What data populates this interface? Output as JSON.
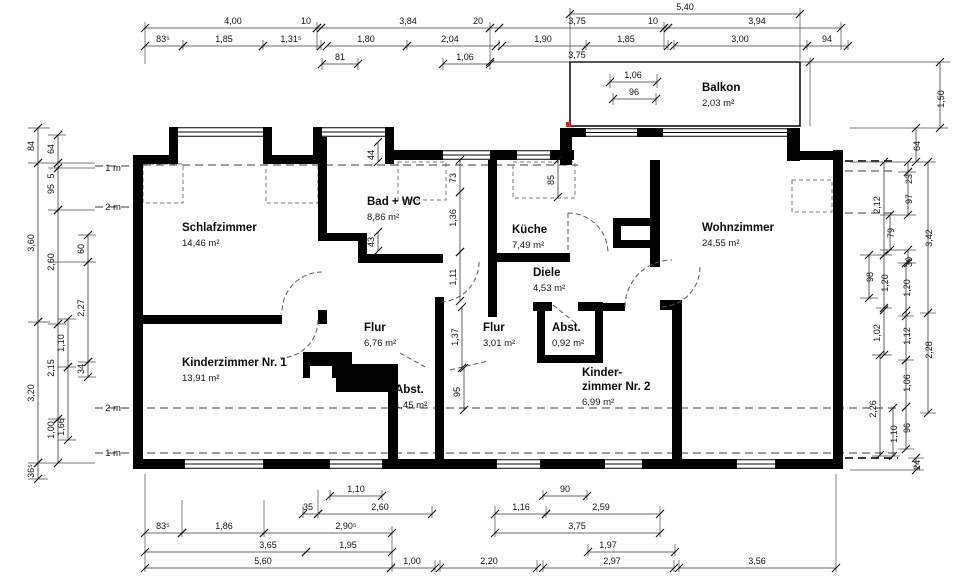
{
  "plan": {
    "rooms": [
      {
        "name": "Schlafzimmer",
        "area": "14,46 m²",
        "x": 182,
        "y": 231
      },
      {
        "name": "Bad + WC",
        "area": "8,86 m²",
        "x": 367,
        "y": 205
      },
      {
        "name": "Küche",
        "area": "7,49 m²",
        "x": 512,
        "y": 233
      },
      {
        "name": "Diele",
        "area": "4,53 m²",
        "x": 533,
        "y": 276
      },
      {
        "name": "Wohnzimmer",
        "area": "24,55 m²",
        "x": 702,
        "y": 231
      },
      {
        "name": "Balkon",
        "area": "2,03 m²",
        "x": 702,
        "y": 91
      },
      {
        "name": "Flur",
        "area": "6,76 m²",
        "x": 364,
        "y": 331
      },
      {
        "name": "Flur",
        "area": "3,01 m²",
        "x": 483,
        "y": 331
      },
      {
        "name": "Abst.",
        "area": "0,92 m²",
        "x": 552,
        "y": 331
      },
      {
        "name": "Kinderzimmer Nr. 1",
        "area": "13,91 m²",
        "x": 182,
        "y": 366
      },
      {
        "name": "Abst.",
        "area": "1,45 m²",
        "x": 395,
        "y": 393
      },
      {
        "name": "Kinder-|zimmer Nr. 2",
        "area": "6,99 m²",
        "x": 582,
        "y": 376
      }
    ],
    "height_labels": [
      {
        "t": "1 m",
        "x": 113,
        "y": 171
      },
      {
        "t": "2 m",
        "x": 113,
        "y": 210
      },
      {
        "t": "2 m",
        "x": 113,
        "y": 411
      },
      {
        "t": "1 m",
        "x": 113,
        "y": 456
      }
    ],
    "dimensions": [
      {
        "t": "5,40",
        "o": "h",
        "l": [
          570,
          14,
          800,
          14
        ],
        "x": 685,
        "y": 10
      },
      {
        "t": "4,00",
        "o": "h",
        "l": [
          145,
          28,
          317,
          28
        ],
        "x": 233,
        "y": 24
      },
      {
        "t": "10",
        "o": "h",
        "l": [
          317,
          28,
          321,
          28
        ],
        "x": 306,
        "y": 24
      },
      {
        "t": "3,84",
        "o": "h",
        "l": [
          321,
          28,
          490,
          28
        ],
        "x": 408,
        "y": 24
      },
      {
        "t": "20",
        "o": "h",
        "l": [
          490,
          28,
          499,
          28
        ],
        "x": 478,
        "y": 24
      },
      {
        "t": "3,75",
        "o": "h",
        "l": [
          499,
          28,
          664,
          28
        ],
        "x": 577,
        "y": 24
      },
      {
        "t": "10",
        "o": "h",
        "l": [
          664,
          28,
          668,
          28
        ],
        "x": 653,
        "y": 24
      },
      {
        "t": "3,94",
        "o": "h",
        "l": [
          668,
          28,
          841,
          28
        ],
        "x": 757,
        "y": 24
      },
      {
        "t": "83⁵",
        "o": "h",
        "l": [
          145,
          46,
          183,
          46
        ],
        "x": 163,
        "y": 42
      },
      {
        "t": "1,85",
        "o": "h",
        "l": [
          183,
          46,
          263,
          46
        ],
        "x": 224,
        "y": 42
      },
      {
        "t": "1,31⁵",
        "o": "h",
        "l": [
          263,
          46,
          321,
          46
        ],
        "x": 291,
        "y": 42
      },
      {
        "t": "1,80",
        "o": "h",
        "l": [
          327,
          46,
          407,
          46
        ],
        "x": 366,
        "y": 42
      },
      {
        "t": "2,04",
        "o": "h",
        "l": [
          407,
          46,
          496,
          46
        ],
        "x": 450,
        "y": 42
      },
      {
        "t": "1,90",
        "o": "h",
        "l": [
          502,
          46,
          586,
          46
        ],
        "x": 543,
        "y": 42
      },
      {
        "t": "1,85",
        "o": "h",
        "l": [
          586,
          46,
          668,
          46
        ],
        "x": 626,
        "y": 42
      },
      {
        "t": "3,00",
        "o": "h",
        "l": [
          674,
          46,
          807,
          46
        ],
        "x": 740,
        "y": 42
      },
      {
        "t": "94",
        "o": "h",
        "l": [
          807,
          46,
          848,
          46
        ],
        "x": 827,
        "y": 42
      },
      {
        "t": "81",
        "o": "h",
        "l": [
          322,
          64,
          358,
          64
        ],
        "x": 340,
        "y": 60
      },
      {
        "t": "1,06",
        "o": "h",
        "l": [
          443,
          64,
          490,
          64
        ],
        "x": 465,
        "y": 60
      },
      {
        "t": "3,75",
        "o": "h",
        "l": [
          490,
          62,
          810,
          62
        ],
        "x": 577,
        "y": 58
      },
      {
        "t": "1,06",
        "o": "h",
        "l": [
          610,
          82,
          657,
          82
        ],
        "x": 633,
        "y": 78
      },
      {
        "t": "96",
        "o": "h",
        "l": [
          613,
          99,
          656,
          99
        ],
        "x": 634,
        "y": 95
      },
      {
        "t": "84",
        "o": "v",
        "l": [
          38,
          128,
          38,
          163
        ],
        "x": 34,
        "y": 146
      },
      {
        "t": "3,60",
        "o": "v",
        "l": [
          38,
          163,
          38,
          322
        ],
        "x": 34,
        "y": 243
      },
      {
        "t": "3,20",
        "o": "v",
        "l": [
          38,
          322,
          38,
          463
        ],
        "x": 34,
        "y": 393
      },
      {
        "t": "36⁵",
        "o": "v",
        "l": [
          38,
          463,
          38,
          479
        ],
        "x": 34,
        "y": 471
      },
      {
        "t": "64",
        "o": "v",
        "l": [
          58,
          135,
          58,
          163
        ],
        "x": 54,
        "y": 149
      },
      {
        "t": "5",
        "o": "v",
        "l": [
          58,
          163,
          58,
          168
        ],
        "x": 54,
        "y": 176
      },
      {
        "t": "95",
        "o": "v",
        "l": [
          58,
          168,
          58,
          210
        ],
        "x": 54,
        "y": 189
      },
      {
        "t": "2,60",
        "o": "v",
        "l": [
          58,
          210,
          58,
          324
        ],
        "x": 54,
        "y": 262
      },
      {
        "t": "2,15",
        "o": "v",
        "l": [
          58,
          324,
          58,
          419
        ],
        "x": 54,
        "y": 368
      },
      {
        "t": "1,00",
        "o": "v",
        "l": [
          58,
          419,
          58,
          463
        ],
        "x": 54,
        "y": 430
      },
      {
        "t": "60",
        "o": "v",
        "l": [
          88,
          235,
          88,
          262
        ],
        "x": 84,
        "y": 249
      },
      {
        "t": "2,27",
        "o": "v",
        "l": [
          88,
          262,
          88,
          362
        ],
        "x": 84,
        "y": 308
      },
      {
        "t": "34",
        "o": "v",
        "l": [
          88,
          362,
          88,
          377
        ],
        "x": 84,
        "y": 369
      },
      {
        "t": "1,10",
        "o": "v",
        "l": [
          68,
          319,
          68,
          367
        ],
        "x": 64,
        "y": 343
      },
      {
        "t": "1,66",
        "o": "v",
        "l": [
          68,
          367,
          68,
          440
        ],
        "x": 64,
        "y": 427
      },
      {
        "t": "1,50",
        "o": "v",
        "l": [
          940,
          62,
          940,
          128
        ],
        "x": 944,
        "y": 99
      },
      {
        "t": "64",
        "o": "v",
        "l": [
          916,
          128,
          916,
          162
        ],
        "x": 920,
        "y": 146
      },
      {
        "t": "23",
        "o": "v",
        "l": [
          908,
          162,
          908,
          172
        ],
        "x": 912,
        "y": 179
      },
      {
        "t": "97",
        "o": "v",
        "l": [
          908,
          172,
          908,
          215
        ],
        "x": 912,
        "y": 199
      },
      {
        "t": "79",
        "o": "v",
        "l": [
          890,
          215,
          890,
          250
        ],
        "x": 894,
        "y": 233
      },
      {
        "t": "30",
        "o": "v",
        "l": [
          908,
          250,
          908,
          263
        ],
        "x": 912,
        "y": 262
      },
      {
        "t": "2,12",
        "o": "v",
        "l": [
          884,
          162,
          884,
          255
        ],
        "x": 880,
        "y": 205
      },
      {
        "t": "98",
        "o": "v",
        "l": [
          869,
          255,
          869,
          298
        ],
        "x": 873,
        "y": 277
      },
      {
        "t": "1,20",
        "o": "v",
        "l": [
          884,
          255,
          884,
          308
        ],
        "x": 888,
        "y": 283
      },
      {
        "t": "1,20",
        "o": "v",
        "l": [
          906,
          263,
          906,
          316
        ],
        "x": 910,
        "y": 288
      },
      {
        "t": "3,42",
        "o": "v",
        "l": [
          928,
          162,
          928,
          313
        ],
        "x": 932,
        "y": 238
      },
      {
        "t": "1,02",
        "o": "v",
        "l": [
          884,
          310,
          884,
          355
        ],
        "x": 880,
        "y": 333
      },
      {
        "t": "1,12",
        "o": "v",
        "l": [
          906,
          311,
          906,
          360
        ],
        "x": 910,
        "y": 336
      },
      {
        "t": "2,28",
        "o": "v",
        "l": [
          928,
          313,
          928,
          413
        ],
        "x": 932,
        "y": 350
      },
      {
        "t": "1,06",
        "o": "v",
        "l": [
          906,
          360,
          906,
          407
        ],
        "x": 910,
        "y": 383
      },
      {
        "t": "2,26",
        "o": "v",
        "l": [
          880,
          355,
          880,
          455
        ],
        "x": 876,
        "y": 409
      },
      {
        "t": "96",
        "o": "v",
        "l": [
          906,
          407,
          906,
          449
        ],
        "x": 910,
        "y": 428
      },
      {
        "t": "1,10",
        "o": "v",
        "l": [
          893,
          408,
          893,
          456
        ],
        "x": 897,
        "y": 434
      },
      {
        "t": "24",
        "o": "v",
        "l": [
          916,
          458,
          916,
          470
        ],
        "x": 920,
        "y": 465
      },
      {
        "t": "1,10",
        "o": "h",
        "l": [
          330,
          496,
          382,
          496
        ],
        "x": 356,
        "y": 492
      },
      {
        "t": "90",
        "o": "h",
        "l": [
          543,
          496,
          587,
          496
        ],
        "x": 565,
        "y": 492
      },
      {
        "t": "35",
        "o": "h",
        "l": [
          303,
          514,
          318,
          514
        ],
        "x": 308,
        "y": 510
      },
      {
        "t": "2,60",
        "o": "h",
        "l": [
          318,
          514,
          432,
          514
        ],
        "x": 380,
        "y": 510
      },
      {
        "t": "1,16",
        "o": "h",
        "l": [
          495,
          514,
          546,
          514
        ],
        "x": 521,
        "y": 510
      },
      {
        "t": "2,59",
        "o": "h",
        "l": [
          546,
          514,
          660,
          514
        ],
        "x": 601,
        "y": 510
      },
      {
        "t": "83⁵",
        "o": "h",
        "l": [
          145,
          533,
          182,
          533
        ],
        "x": 163,
        "y": 529
      },
      {
        "t": "1,86",
        "o": "h",
        "l": [
          182,
          533,
          264,
          533
        ],
        "x": 224,
        "y": 529
      },
      {
        "t": "2,90⁵",
        "o": "h",
        "l": [
          264,
          533,
          392,
          533
        ],
        "x": 346,
        "y": 529
      },
      {
        "t": "3,75",
        "o": "h",
        "l": [
          495,
          533,
          660,
          533
        ],
        "x": 577,
        "y": 529
      },
      {
        "t": "3,65",
        "o": "h",
        "l": [
          145,
          552,
          306,
          552
        ],
        "x": 268,
        "y": 548
      },
      {
        "t": "1,95",
        "o": "h",
        "l": [
          306,
          552,
          392,
          552
        ],
        "x": 348,
        "y": 548
      },
      {
        "t": "1,97",
        "o": "h",
        "l": [
          588,
          552,
          675,
          552
        ],
        "x": 608,
        "y": 548
      },
      {
        "t": "5,60",
        "o": "h",
        "l": [
          145,
          568,
          391,
          568
        ],
        "x": 263,
        "y": 564
      },
      {
        "t": "1,00",
        "o": "h",
        "l": [
          391,
          568,
          435,
          568
        ],
        "x": 412,
        "y": 564
      },
      {
        "t": "2,20",
        "o": "h",
        "l": [
          440,
          568,
          537,
          568
        ],
        "x": 489,
        "y": 564
      },
      {
        "t": "2,97",
        "o": "h",
        "l": [
          543,
          568,
          674,
          568
        ],
        "x": 612,
        "y": 564
      },
      {
        "t": "3,56",
        "o": "h",
        "l": [
          679,
          568,
          836,
          568
        ],
        "x": 757,
        "y": 564
      },
      {
        "t": "44",
        "o": "v",
        "l": [
          378,
          142,
          378,
          162
        ],
        "x": 374,
        "y": 155
      },
      {
        "t": "73",
        "o": "v",
        "l": [
          460,
          160,
          460,
          192
        ],
        "x": 456,
        "y": 178
      },
      {
        "t": "1,36",
        "o": "v",
        "l": [
          460,
          192,
          460,
          252
        ],
        "x": 456,
        "y": 218
      },
      {
        "t": "1,11",
        "o": "v",
        "l": [
          460,
          252,
          460,
          301
        ],
        "x": 456,
        "y": 277
      },
      {
        "t": "1,37",
        "o": "v",
        "l": [
          462,
          307,
          462,
          368
        ],
        "x": 458,
        "y": 337
      },
      {
        "t": "95",
        "o": "v",
        "l": [
          464,
          368,
          464,
          410
        ],
        "x": 460,
        "y": 392
      },
      {
        "t": "43",
        "o": "v",
        "l": [
          378,
          232,
          378,
          251
        ],
        "x": 374,
        "y": 242
      },
      {
        "t": "85",
        "o": "v",
        "l": [
          558,
          160,
          558,
          197
        ],
        "x": 554,
        "y": 180
      }
    ],
    "colors": {
      "wall": "#000000",
      "red_mark": "#cc2418",
      "dim_line": "#3a3a3a"
    }
  }
}
